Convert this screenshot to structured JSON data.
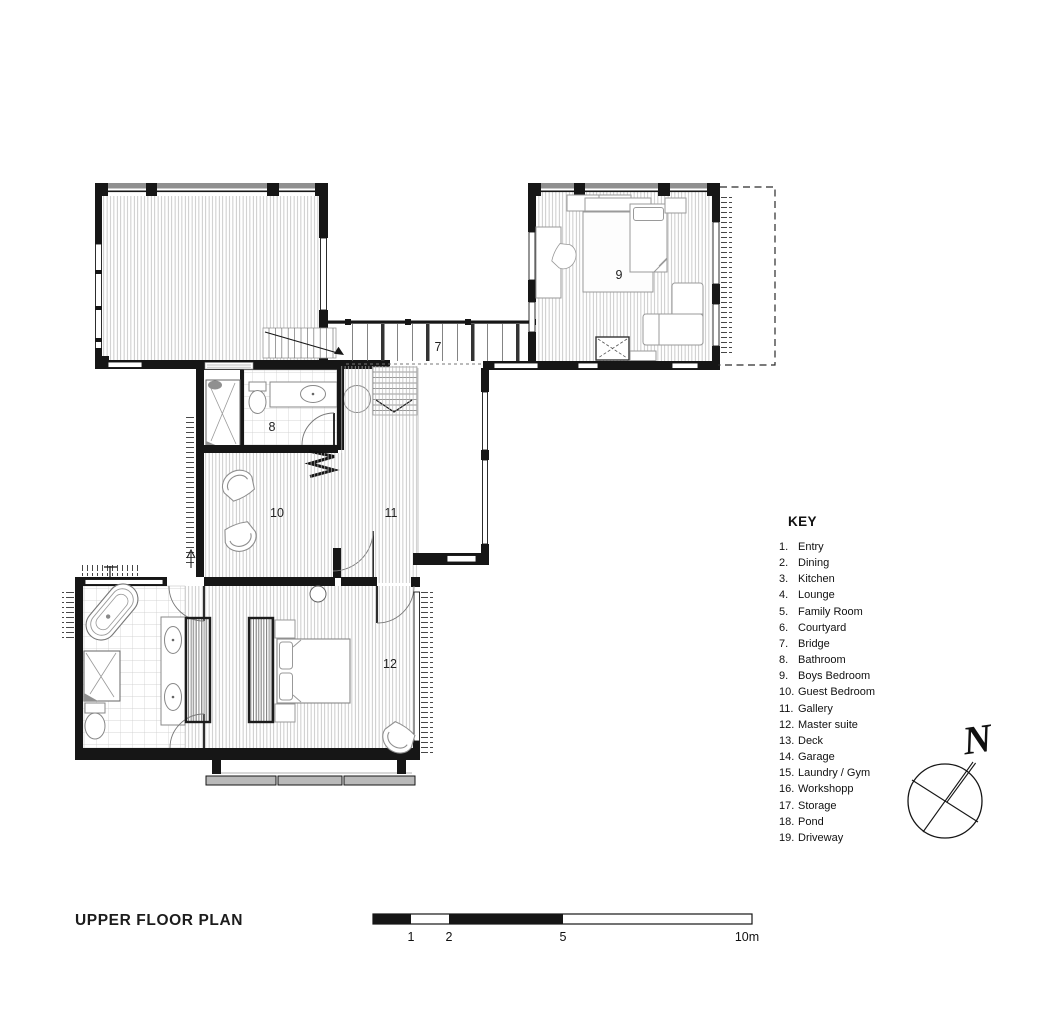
{
  "title": "UPPER FLOOR PLAN",
  "key": {
    "heading": "KEY",
    "items": [
      {
        "num": "1.",
        "label": "Entry"
      },
      {
        "num": "2.",
        "label": "Dining"
      },
      {
        "num": "3.",
        "label": "Kitchen"
      },
      {
        "num": "4.",
        "label": "Lounge"
      },
      {
        "num": "5.",
        "label": "Family Room"
      },
      {
        "num": "6.",
        "label": "Courtyard"
      },
      {
        "num": "7.",
        "label": "Bridge"
      },
      {
        "num": "8.",
        "label": "Bathroom"
      },
      {
        "num": "9.",
        "label": "Boys Bedroom"
      },
      {
        "num": "10.",
        "label": "Guest Bedroom"
      },
      {
        "num": "11.",
        "label": "Gallery"
      },
      {
        "num": "12.",
        "label": "Master suite"
      },
      {
        "num": "13.",
        "label": "Deck"
      },
      {
        "num": "14.",
        "label": "Garage"
      },
      {
        "num": "15.",
        "label": "Laundry / Gym"
      },
      {
        "num": "16.",
        "label": "Workshopp"
      },
      {
        "num": "17.",
        "label": "Storage"
      },
      {
        "num": "18.",
        "label": "Pond"
      },
      {
        "num": "19.",
        "label": "Driveway"
      }
    ]
  },
  "rooms": {
    "bridge": "7",
    "bathroom": "8",
    "boys_bedroom": "9",
    "guest_bedroom": "10",
    "gallery": "11",
    "master_suite": "12"
  },
  "compass": {
    "north": "N"
  },
  "scale_bar": {
    "ticks": [
      {
        "label": "1"
      },
      {
        "label": "2"
      },
      {
        "label": "5"
      },
      {
        "label": "10m"
      }
    ]
  },
  "colors": {
    "wall": "#161616",
    "hatch": "#b4b4b4",
    "tile": "#c9c9c9"
  }
}
